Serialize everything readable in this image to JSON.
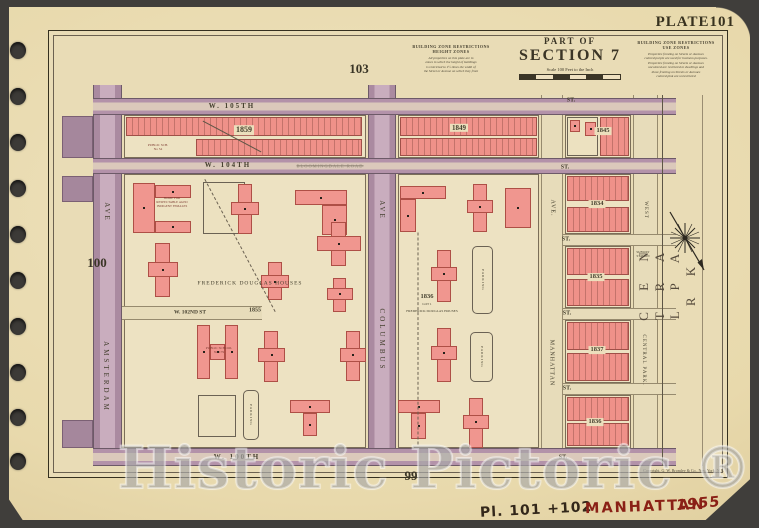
{
  "page": {
    "plate_label": "PLATE101",
    "adjacent": {
      "top": "103",
      "left": "100",
      "bottom": "99"
    },
    "copyright": "Copyright, G. W. Bromley & Co., New York, N.Y.",
    "watermark": "Historic Pictoric ®",
    "binding_holes": [
      50,
      96,
      142,
      188,
      234,
      280,
      326,
      372,
      417,
      461
    ]
  },
  "header": {
    "part_of": "PART OF",
    "section": "SECTION 7",
    "scale": "Scale 100 Feet to the Inch"
  },
  "legend": {
    "height": {
      "title": "BUILDING ZONE RESTRICTIONS",
      "subtitle": "HEIGHT ZONES",
      "body": "All properties on this plate are in\nzones in which the height of buildings\nis restricted to 1½ times the width of\nthe Street or Avenue on which they front"
    },
    "use": {
      "title": "BUILDING ZONE RESTRICTIONS",
      "subtitle": "USE ZONES",
      "body": "Properties fronting on Streets or Avenues\ncolored purple are used for business purposes.\nProperties fronting on Streets or Avenues\nuncolored are restricted to dwellings and\nthose fronting on Streets or Avenues\ncolored pink are unrestricted"
    }
  },
  "notes": {
    "plate_note": "Pl. 101 +102",
    "borough": "MANHATTAN",
    "year": "1955"
  },
  "colors": {
    "paper": "#e8d9ac",
    "block_fill": "#ede2c2",
    "building_pink": "#f0968f",
    "building_outline": "#ae4f46",
    "street_purple": "#b392a9",
    "surround_dark": "#403e3b",
    "handwriting_red": "#8a2016",
    "handwriting_brown": "#33271a"
  },
  "map": {
    "edge_stubs": [
      {
        "x": 62,
        "y": 116,
        "w": 31,
        "h": 42
      },
      {
        "x": 62,
        "y": 176,
        "w": 31,
        "h": 26
      },
      {
        "x": 62,
        "y": 420,
        "w": 31,
        "h": 28
      }
    ],
    "avenues": [
      {
        "name": "amsterdam-ave",
        "kind": "purple",
        "x": 93,
        "y": 85,
        "w": 29,
        "h": 381
      },
      {
        "name": "columbus-ave",
        "kind": "purple",
        "x": 368,
        "y": 85,
        "w": 28,
        "h": 381
      },
      {
        "name": "manhattan-ave",
        "kind": "cream",
        "x": 541,
        "y": 95,
        "w": 22,
        "h": 371
      },
      {
        "name": "central-park-west",
        "kind": "cream",
        "x": 633,
        "y": 95,
        "w": 25,
        "h": 371
      }
    ],
    "blocks": [
      {
        "name": "block-1859",
        "x": 124,
        "y": 115,
        "w": 242,
        "h": 43
      },
      {
        "name": "block-1849",
        "x": 398,
        "y": 115,
        "w": 141,
        "h": 43
      },
      {
        "name": "block-1845",
        "x": 565,
        "y": 115,
        "w": 66,
        "h": 43
      },
      {
        "name": "block-frederick-douglas-west",
        "x": 124,
        "y": 174,
        "w": 242,
        "h": 274
      },
      {
        "name": "block-frederick-douglas-east",
        "x": 398,
        "y": 174,
        "w": 141,
        "h": 274
      },
      {
        "name": "block-1834",
        "x": 565,
        "y": 174,
        "w": 66,
        "h": 60
      },
      {
        "name": "block-1835",
        "x": 565,
        "y": 246,
        "w": 66,
        "h": 62
      },
      {
        "name": "block-1837",
        "x": 565,
        "y": 320,
        "w": 66,
        "h": 63
      },
      {
        "name": "block-1836",
        "x": 565,
        "y": 395,
        "w": 66,
        "h": 53
      }
    ],
    "streets": [
      {
        "name": "w-105th-st",
        "kind": "purple",
        "x": 93,
        "y": 98,
        "w": 583,
        "h": 17
      },
      {
        "name": "w-104th-st",
        "kind": "purple",
        "x": 93,
        "y": 158,
        "w": 583,
        "h": 16
      },
      {
        "name": "w-100th-st",
        "kind": "purple",
        "x": 93,
        "y": 448,
        "w": 583,
        "h": 18
      },
      {
        "name": "w-103rd-st",
        "kind": "cream",
        "x": 563,
        "y": 234,
        "w": 113,
        "h": 12
      },
      {
        "name": "w-102nd-st-east",
        "kind": "cream",
        "x": 563,
        "y": 308,
        "w": 113,
        "h": 12
      },
      {
        "name": "w-101st-st",
        "kind": "cream",
        "x": 563,
        "y": 383,
        "w": 113,
        "h": 12
      },
      {
        "name": "w-102nd-st-stub",
        "kind": "cream",
        "x": 122,
        "y": 306,
        "w": 140,
        "h": 14
      }
    ],
    "strips": [
      {
        "x": 126,
        "y": 117,
        "w": 236,
        "h": 19
      },
      {
        "x": 196,
        "y": 139,
        "w": 166,
        "h": 17
      },
      {
        "x": 400,
        "y": 117,
        "w": 137,
        "h": 19
      },
      {
        "x": 400,
        "y": 138,
        "w": 137,
        "h": 18
      },
      {
        "x": 600,
        "y": 117,
        "w": 29,
        "h": 39
      },
      {
        "x": 567,
        "y": 176,
        "w": 62,
        "h": 25
      },
      {
        "x": 567,
        "y": 207,
        "w": 62,
        "h": 25
      },
      {
        "x": 567,
        "y": 248,
        "w": 62,
        "h": 27
      },
      {
        "x": 567,
        "y": 279,
        "w": 62,
        "h": 27
      },
      {
        "x": 567,
        "y": 322,
        "w": 62,
        "h": 28
      },
      {
        "x": 567,
        "y": 353,
        "w": 62,
        "h": 28
      },
      {
        "x": 567,
        "y": 397,
        "w": 62,
        "h": 24
      },
      {
        "x": 567,
        "y": 423,
        "w": 62,
        "h": 23
      }
    ],
    "buildings": [
      {
        "x": 567,
        "y": 117,
        "w": 31,
        "h": 39,
        "f": "c"
      },
      {
        "x": 570,
        "y": 120,
        "w": 10,
        "h": 12
      },
      {
        "x": 585,
        "y": 122,
        "w": 11,
        "h": 14
      },
      {
        "x": 133,
        "y": 183,
        "w": 22,
        "h": 50
      },
      {
        "x": 155,
        "y": 185,
        "w": 36,
        "h": 13
      },
      {
        "x": 155,
        "y": 221,
        "w": 36,
        "h": 12
      },
      {
        "x": 203,
        "y": 182,
        "w": 42,
        "h": 52,
        "f": "c"
      },
      {
        "x": 238,
        "y": 184,
        "w": 14,
        "h": 50
      },
      {
        "x": 231,
        "y": 202,
        "w": 28,
        "h": 13
      },
      {
        "x": 295,
        "y": 190,
        "w": 52,
        "h": 15
      },
      {
        "x": 322,
        "y": 205,
        "w": 25,
        "h": 30
      },
      {
        "x": 155,
        "y": 243,
        "w": 15,
        "h": 54
      },
      {
        "x": 148,
        "y": 262,
        "w": 30,
        "h": 15
      },
      {
        "x": 268,
        "y": 262,
        "w": 14,
        "h": 38
      },
      {
        "x": 261,
        "y": 275,
        "w": 28,
        "h": 13
      },
      {
        "x": 331,
        "y": 222,
        "w": 15,
        "h": 44
      },
      {
        "x": 317,
        "y": 236,
        "w": 44,
        "h": 15
      },
      {
        "x": 333,
        "y": 278,
        "w": 13,
        "h": 34
      },
      {
        "x": 327,
        "y": 288,
        "w": 26,
        "h": 12
      },
      {
        "x": 197,
        "y": 325,
        "w": 13,
        "h": 54
      },
      {
        "x": 225,
        "y": 325,
        "w": 13,
        "h": 54
      },
      {
        "x": 210,
        "y": 344,
        "w": 15,
        "h": 16
      },
      {
        "x": 264,
        "y": 331,
        "w": 14,
        "h": 51
      },
      {
        "x": 258,
        "y": 348,
        "w": 27,
        "h": 14
      },
      {
        "x": 346,
        "y": 331,
        "w": 14,
        "h": 50
      },
      {
        "x": 340,
        "y": 348,
        "w": 26,
        "h": 14
      },
      {
        "x": 198,
        "y": 395,
        "w": 38,
        "h": 42,
        "f": "c"
      },
      {
        "x": 243,
        "y": 390,
        "w": 16,
        "h": 50,
        "f": "c",
        "r": true
      },
      {
        "x": 290,
        "y": 400,
        "w": 40,
        "h": 13
      },
      {
        "x": 303,
        "y": 413,
        "w": 14,
        "h": 23
      },
      {
        "x": 400,
        "y": 186,
        "w": 46,
        "h": 13
      },
      {
        "x": 400,
        "y": 199,
        "w": 16,
        "h": 33
      },
      {
        "x": 473,
        "y": 184,
        "w": 14,
        "h": 48
      },
      {
        "x": 467,
        "y": 200,
        "w": 26,
        "h": 13
      },
      {
        "x": 505,
        "y": 188,
        "w": 26,
        "h": 40
      },
      {
        "x": 437,
        "y": 250,
        "w": 14,
        "h": 52
      },
      {
        "x": 431,
        "y": 267,
        "w": 26,
        "h": 14
      },
      {
        "x": 472,
        "y": 246,
        "w": 21,
        "h": 68,
        "f": "c",
        "r": true
      },
      {
        "x": 437,
        "y": 328,
        "w": 14,
        "h": 54
      },
      {
        "x": 431,
        "y": 346,
        "w": 26,
        "h": 14
      },
      {
        "x": 470,
        "y": 332,
        "w": 23,
        "h": 50,
        "f": "c",
        "r": true
      },
      {
        "x": 398,
        "y": 400,
        "w": 42,
        "h": 13
      },
      {
        "x": 411,
        "y": 413,
        "w": 15,
        "h": 26
      },
      {
        "x": 469,
        "y": 398,
        "w": 14,
        "h": 50
      },
      {
        "x": 463,
        "y": 415,
        "w": 26,
        "h": 14
      }
    ],
    "lines": [
      {
        "cx": 662,
        "cy": 280,
        "len": 371,
        "rot": 90
      },
      {
        "cx": 702,
        "cy": 280,
        "len": 371,
        "rot": 90,
        "light": true
      },
      {
        "cx": 418,
        "cy": 338,
        "len": 212,
        "rot": 90,
        "dash": true
      },
      {
        "cx": 240,
        "cy": 245,
        "len": 150,
        "rot": 62,
        "dash": true
      },
      {
        "cx": 232,
        "cy": 136,
        "len": 66,
        "rot": 28
      }
    ],
    "labels": [
      {
        "t": "W. 105TH",
        "cx": 232,
        "cy": 106,
        "s": 7,
        "ls": 2,
        "b": 1
      },
      {
        "t": "ST.",
        "cx": 571,
        "cy": 101,
        "s": 6,
        "b": 1
      },
      {
        "t": "W. 104TH",
        "cx": 228,
        "cy": 165,
        "s": 7,
        "ls": 2,
        "b": 1
      },
      {
        "t": "BLOOMINGDALE ROAD",
        "cx": 330,
        "cy": 166,
        "s": 4.5,
        "ls": 1,
        "o": 0.5,
        "strike": 1
      },
      {
        "t": "ST.",
        "cx": 565,
        "cy": 168,
        "s": 6,
        "b": 1
      },
      {
        "t": "ST.",
        "cx": 566,
        "cy": 240,
        "s": 6,
        "b": 1
      },
      {
        "t": "ST.",
        "cx": 567,
        "cy": 314,
        "s": 6,
        "b": 1
      },
      {
        "t": "ST.",
        "cx": 567,
        "cy": 389,
        "s": 6,
        "b": 1
      },
      {
        "t": "W. 100TH",
        "cx": 237,
        "cy": 457,
        "s": 7,
        "ls": 2,
        "b": 1
      },
      {
        "t": "ST.",
        "cx": 563,
        "cy": 458,
        "s": 6,
        "b": 1
      },
      {
        "t": "W. 102ND ST",
        "cx": 190,
        "cy": 313,
        "s": 5.5,
        "b": 1
      },
      {
        "t": "1855",
        "cx": 255,
        "cy": 311,
        "s": 6,
        "b": 1
      },
      {
        "t": "FREDERICK DOUGLAS HOUSES",
        "cx": 250,
        "cy": 284,
        "s": 5.5,
        "ls": 1
      },
      {
        "t": "1836",
        "cx": 427,
        "cy": 297,
        "s": 6.5,
        "b": 1
      },
      {
        "t": "LOT 1",
        "cx": 427,
        "cy": 304,
        "s": 3.5
      },
      {
        "t": "FREDERICK DOUGLAS HOUSES",
        "cx": 432,
        "cy": 311,
        "s": 3.5
      },
      {
        "t": "1859",
        "cx": 244,
        "cy": 130,
        "s": 8,
        "b": 1,
        "pill": 1
      },
      {
        "t": "1849",
        "cx": 459,
        "cy": 128,
        "s": 7,
        "b": 1,
        "pill": 1
      },
      {
        "t": "1845",
        "cx": 603,
        "cy": 131,
        "s": 6.5,
        "b": 1,
        "pill": 1
      },
      {
        "t": "1834",
        "cx": 597,
        "cy": 204,
        "s": 6.5,
        "b": 1,
        "pill": 1
      },
      {
        "t": "1835",
        "cx": 596,
        "cy": 277,
        "s": 6.5,
        "b": 1,
        "pill": 1
      },
      {
        "t": "1837",
        "cx": 597,
        "cy": 350,
        "s": 6.5,
        "b": 1,
        "pill": 1
      },
      {
        "t": "1836",
        "cx": 595,
        "cy": 422,
        "s": 6.5,
        "b": 1,
        "pill": 1
      },
      {
        "t": "AVE",
        "cx": 107,
        "cy": 212,
        "s": 7,
        "r": 90,
        "ls": 2
      },
      {
        "t": "AMSTERDAM",
        "cx": 106,
        "cy": 377,
        "s": 7,
        "r": 90,
        "ls": 3
      },
      {
        "t": "AVE",
        "cx": 382,
        "cy": 210,
        "s": 7,
        "r": 90,
        "ls": 2
      },
      {
        "t": "COLUMBUS",
        "cx": 382,
        "cy": 340,
        "s": 7,
        "r": 90,
        "ls": 3
      },
      {
        "t": "AVE.",
        "cx": 552,
        "cy": 208,
        "s": 6,
        "r": 90,
        "ls": 1
      },
      {
        "t": "MANHATTAN",
        "cx": 551,
        "cy": 363,
        "s": 6,
        "r": 90,
        "ls": 1
      },
      {
        "t": "WEST",
        "cx": 645,
        "cy": 210,
        "s": 5,
        "r": 90,
        "ls": 1
      },
      {
        "t": "SUBWAY\nSTATION",
        "cx": 643,
        "cy": 255,
        "s": 3.2
      },
      {
        "t": "CENTRAL PARK.",
        "cx": 643,
        "cy": 360,
        "s": 5,
        "r": 90,
        "ls": 1
      },
      {
        "t": "C E N T R A L     P A R K",
        "cx": 667,
        "cy": 282,
        "s": 13,
        "r": -90,
        "ls": 9,
        "c": "#54493b"
      },
      {
        "t": "PUBLIC SCH.\nNo 54",
        "cx": 158,
        "cy": 147,
        "s": 3.4,
        "c": "#7c3b32"
      },
      {
        "t": "HOME FOR\nRESPECTABLE AGED\nINDIGENT FEMALES",
        "cx": 172,
        "cy": 203,
        "s": 3.2,
        "c": "#7c3b32"
      },
      {
        "t": "PUBLIC SCHOOL\nNo.179",
        "cx": 219,
        "cy": 350,
        "s": 3.4,
        "c": "#7c3b32"
      },
      {
        "t": "PARKING",
        "cx": 483,
        "cy": 280,
        "s": 3.4,
        "r": 90,
        "ls": 1
      },
      {
        "t": "PARKING",
        "cx": 482,
        "cy": 357,
        "s": 3.4,
        "r": 90,
        "ls": 1
      },
      {
        "t": "PARKING",
        "cx": 251,
        "cy": 415,
        "s": 3.4,
        "r": 90,
        "ls": 1
      }
    ]
  }
}
